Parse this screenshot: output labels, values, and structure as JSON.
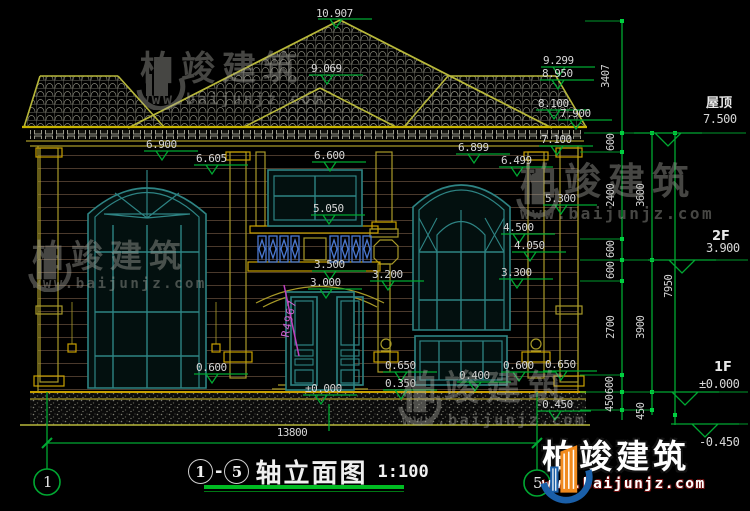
{
  "labels": {
    "apex": "10.907",
    "gable": "9.069",
    "r9299": "9.299",
    "r8950": "8.950",
    "r8100": "8.100",
    "r7900": "7.900",
    "r7100": "7.100",
    "lw_top": "6.900",
    "lw_arch": "6.605",
    "cw_top": "6.600",
    "cw_sill": "5.050",
    "rw_top": "6.899",
    "rw_arch": "6.499",
    "rw_m1": "5.300",
    "rw_m2": "4.500",
    "rw_m3": "4.050",
    "rw_m4": "3.300",
    "balc_top": "3.500",
    "door_arch": "3.000",
    "balc_bot": "3.200",
    "radius": "R4967",
    "base_l": "0.600",
    "base_r1": "0.650",
    "base_r2": "0.350",
    "base_r3": "0.400",
    "base_r4": "0.600",
    "base_r5": "0.650",
    "grade_inner": "-0.450",
    "door_zero": "±0.000"
  },
  "vdims": {
    "d3407": "3407",
    "d600a": "600",
    "d2400": "2400",
    "d600b": "600",
    "d600c": "600",
    "d2700": "2700",
    "d600d": "600",
    "d450a": "450",
    "d3600": "3600",
    "d3900": "3900",
    "d450b": "450",
    "d7950": "7950"
  },
  "levels": {
    "roof_name": "屋顶",
    "roof_value": "7.500",
    "f2_name": "2F",
    "f2_value": "3.900",
    "f1_name": "1F",
    "f1_value": "±0.000",
    "ground_value": "-0.450"
  },
  "overall_width": "13800",
  "axes": {
    "left": "1",
    "right": "5"
  },
  "titlebar": {
    "from": "1",
    "to": "5",
    "dash": "-",
    "title": "轴立面图",
    "scale": "1:100"
  },
  "watermark": {
    "brand": "柏竣建筑",
    "site": "www.baijunjz.com"
  },
  "logo": {
    "brand": "柏竣建筑",
    "site": "www.baijunjz.com"
  },
  "colors": {
    "dim_green": "#00a832",
    "building_yellow": "#a89a28",
    "window_teal": "#2e8484",
    "baluster_blue": "#4a78d0",
    "radius_magenta": "#c040c0",
    "logo_blue": "#1a5fa8",
    "logo_orange": "#f08a1e"
  }
}
